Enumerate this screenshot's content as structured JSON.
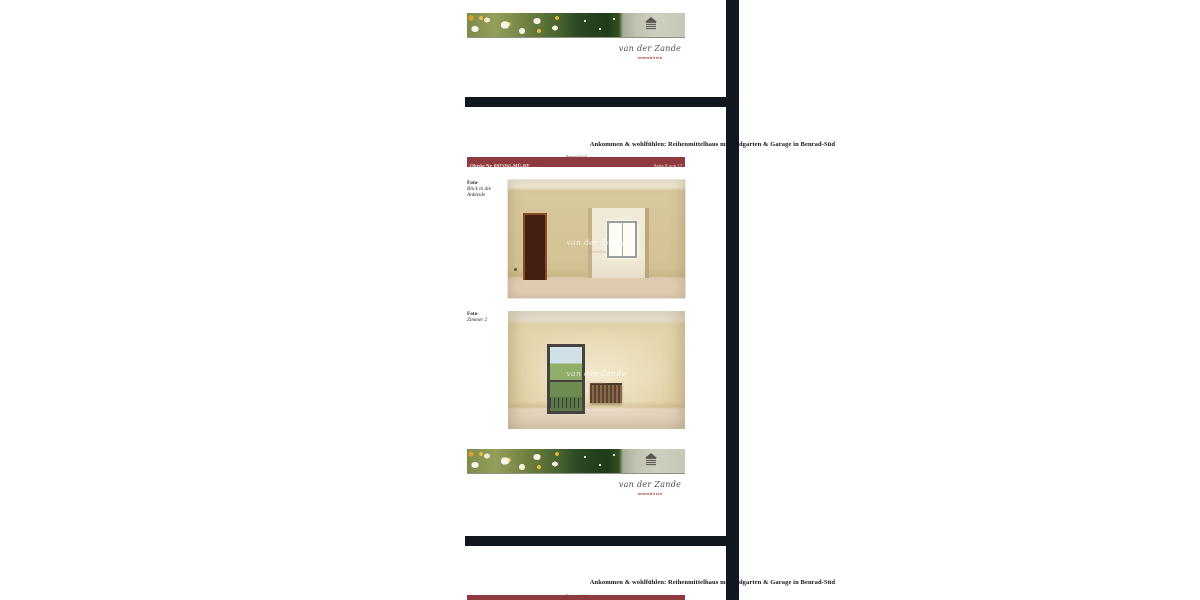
{
  "document": {
    "title": "Ankommen & wohlfühlen: Reihenmittelhaus mit Südgarten & Garage in Benrad-Süd",
    "subtitle": "Benrad-Süd",
    "object_label": "Objekt Nr. 0923261-MÜ-RE",
    "page2_info": "Seite 8 von 12",
    "page3_info": "Seite 9 von 12"
  },
  "logo": {
    "name": "van der Zande",
    "tagline": "Immobilien",
    "watermark": "van der Zande",
    "watermark_sub": "Immobilien"
  },
  "photos": [
    {
      "prefix": "Foto-",
      "lines": [
        "Blick in die",
        "Ankleide"
      ]
    },
    {
      "prefix": "Foto-",
      "lines": [
        "Zimmer 2"
      ]
    }
  ],
  "colors": {
    "separator": "#11171e",
    "object_bar": "#8e3a3e",
    "logo_accent": "#a83a3c",
    "page_background": "#ffffff"
  }
}
